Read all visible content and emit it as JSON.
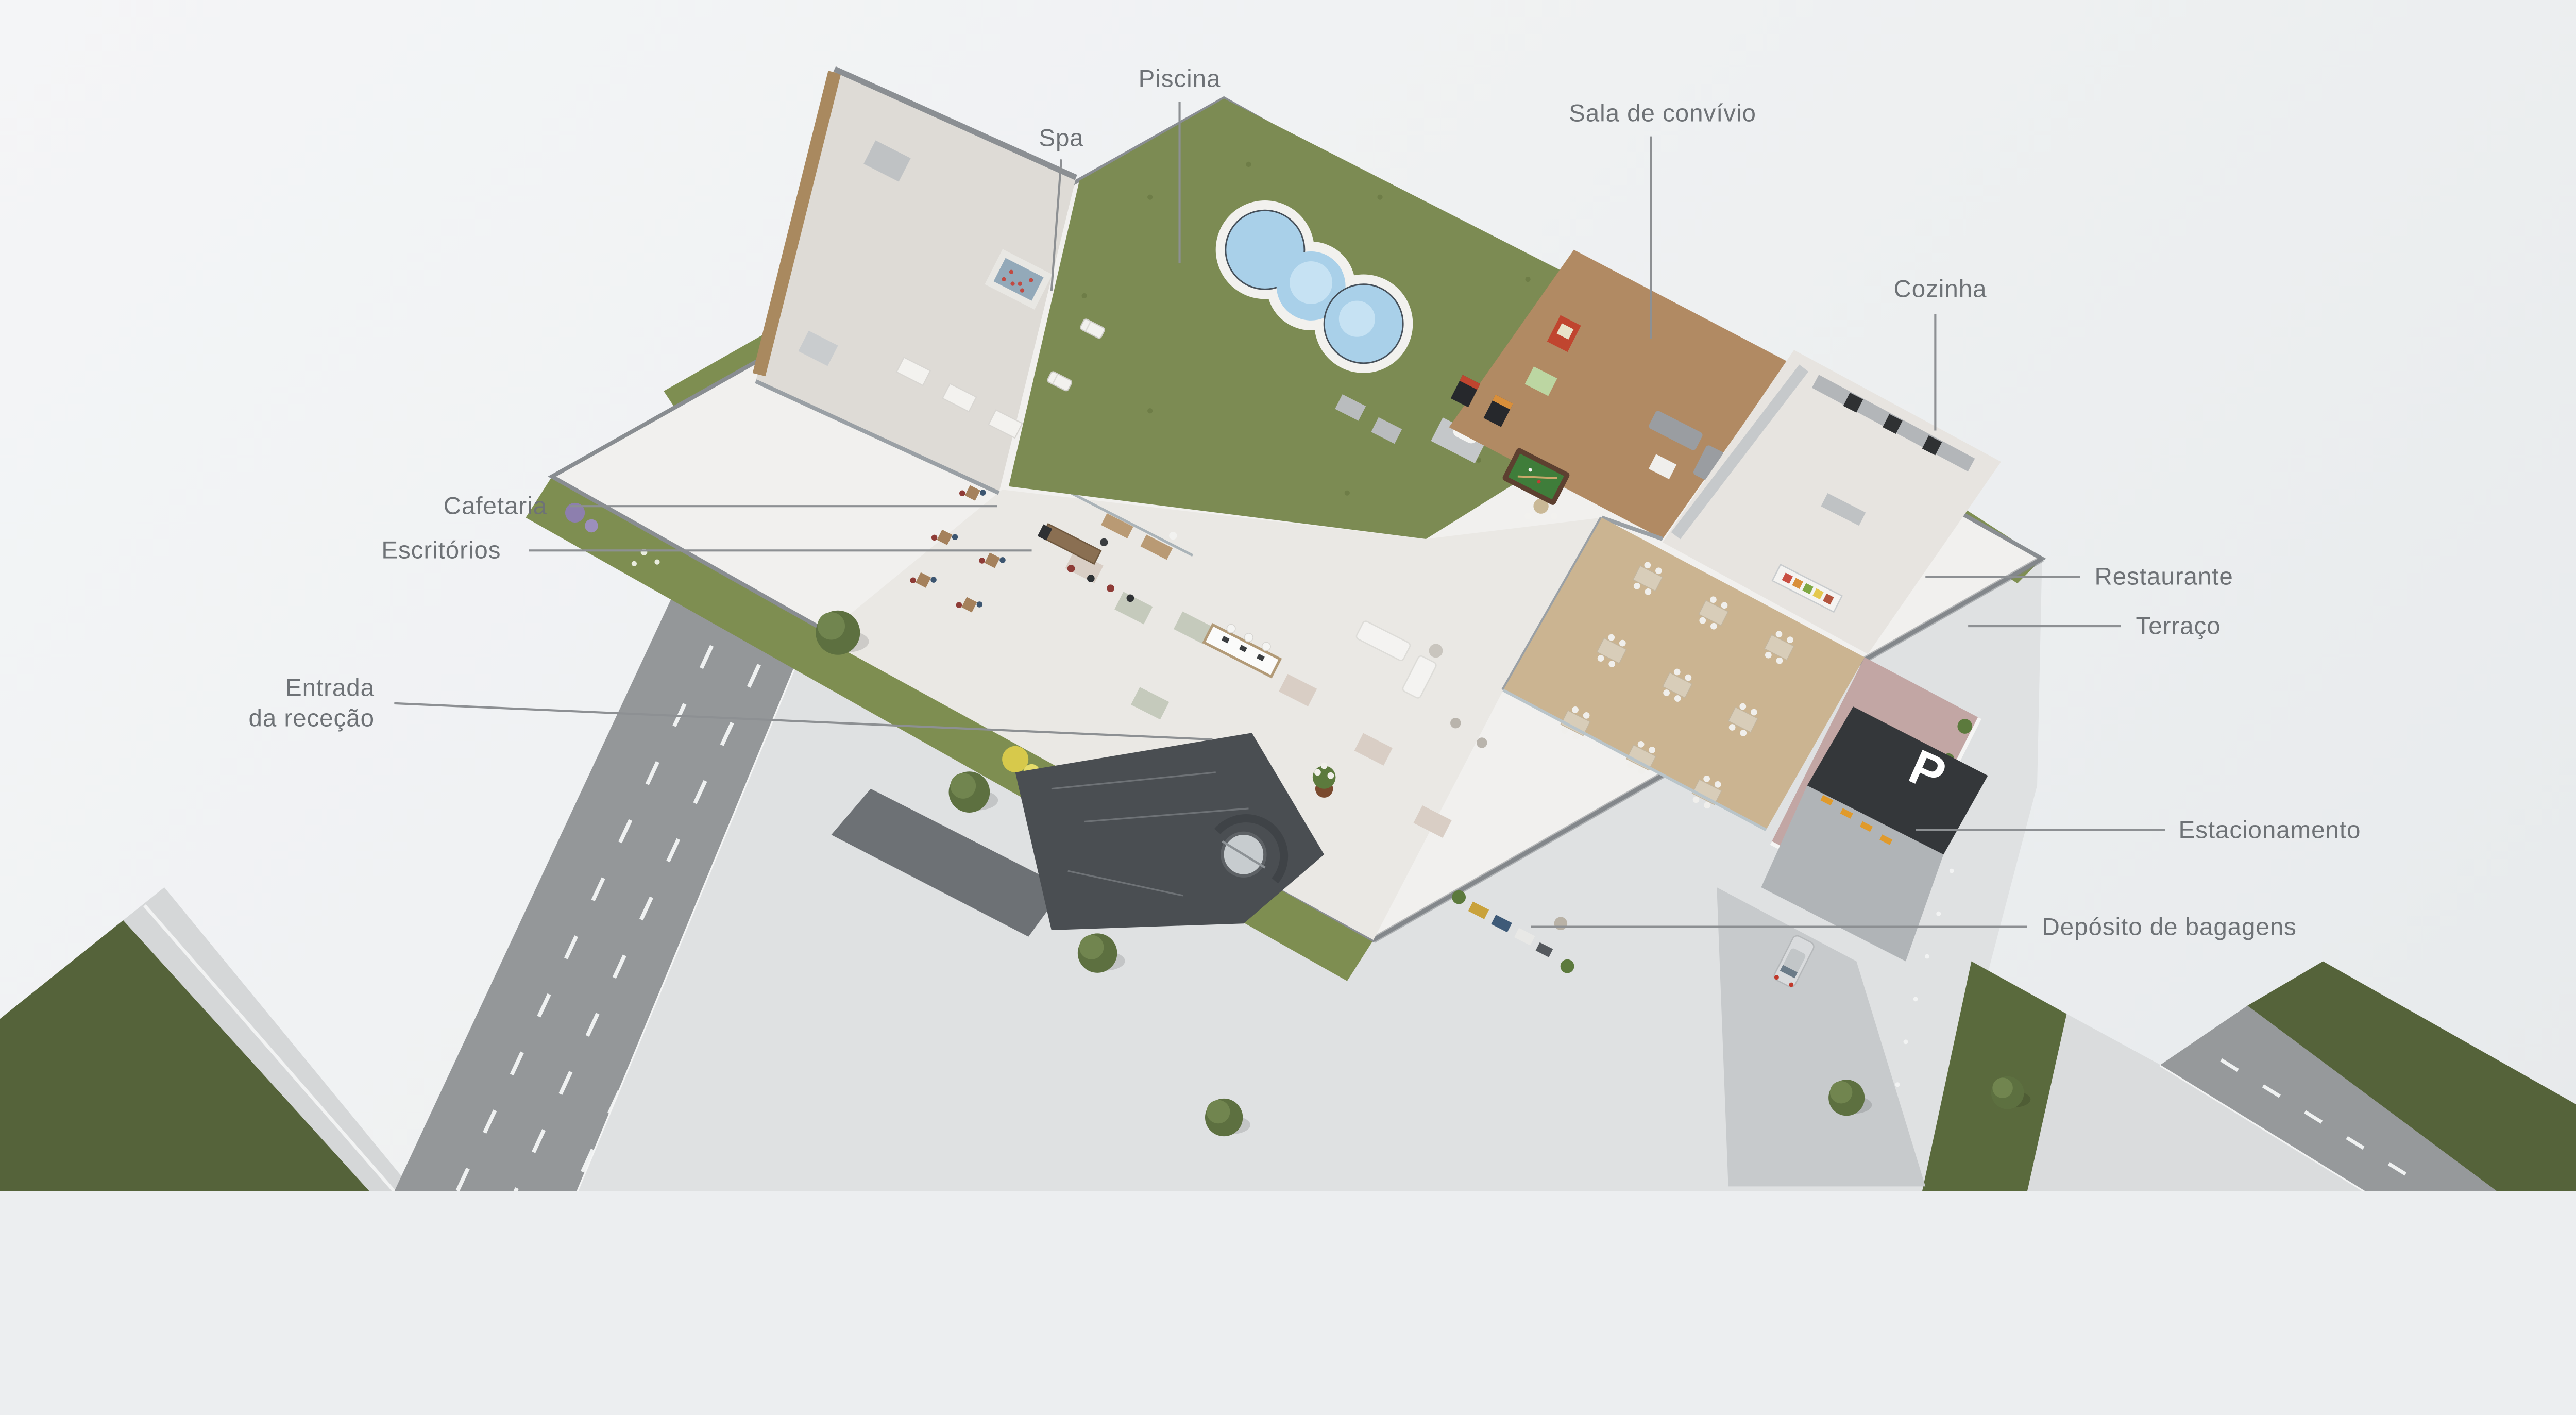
{
  "illustration": {
    "kind": "isometric-hotel-ground-floor-cutaway"
  },
  "labels": {
    "piscina": "Piscina",
    "spa": "Spa",
    "sala_de_convivio": "Sala de convívio",
    "cozinha": "Cozinha",
    "cafetaria": "Cafetaria",
    "escritorios": "Escritórios",
    "entrada_da_rececao": "Entrada\nda receção",
    "restaurante": "Restaurante",
    "terraco": "Terraço",
    "estacionamento": "Estacionamento",
    "deposito_de_bagagens": "Depósito de bagagens"
  },
  "parking_sign": {
    "text": "P"
  },
  "colors": {
    "background_top": "#f4f5f7",
    "background_bottom": "#e7eaec",
    "label_text": "#6e7276",
    "leader_line": "#8d9093",
    "roof_grass": "#7c8b53",
    "street_grass": "#55633a",
    "garden_green": "#7e8e51",
    "pool_water": "#a9d0e9",
    "pool_deck": "#f2f1ee",
    "asphalt": "#949799",
    "concrete_plate": "#dfe1e2",
    "marble_floor": "#eae8e4",
    "wood_floor": "#b18a63",
    "terrace_pavers": "#c2a6a4",
    "building_wall": "#8b8f93",
    "parking_sign_bg": "#34373a",
    "parking_sign_text": "#ffffff",
    "ramp_marking_orange": "#e09a2b",
    "billiard_cloth": "#3f7d3a",
    "flower_yellow": "#d7c94b",
    "flower_red": "#b0413a",
    "flower_purple": "#8d7fae"
  }
}
